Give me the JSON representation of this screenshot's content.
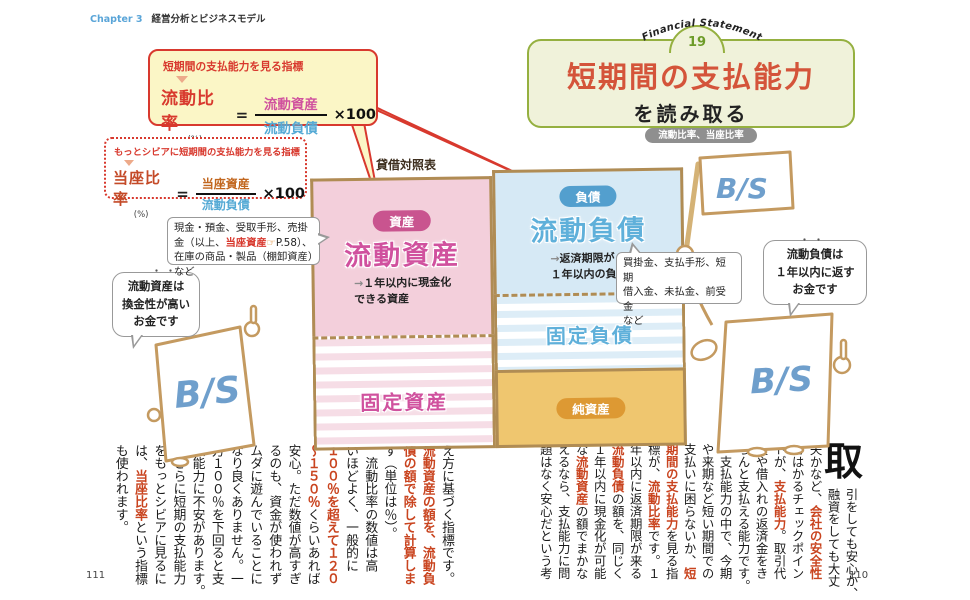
{
  "palette": {
    "accent_red": "#d8392e",
    "title_red": "#d4543a",
    "frame_green": "#95b040",
    "asset_pink": "#d0519e",
    "liability_blue": "#55aad5",
    "sheet_tan": "#b08c54",
    "net_orange": "#dd9933",
    "body_red": "#c9441f",
    "bs_blue": "#6f9fcc"
  },
  "header": {
    "chapter": "Chapter 3",
    "title": "経営分析とビジネスモデル"
  },
  "badge": {
    "arc_text": "Financial Statement",
    "number": "19"
  },
  "title_block": {
    "main": "短期間の支払能力",
    "sub": "を読み取る",
    "pill": "流動比率、当座比率"
  },
  "formulas": {
    "current_ratio": {
      "caption": "短期間の支払能力を見る指標",
      "name": "流動比率",
      "unit": "(%)",
      "equals": "=",
      "numerator": "流動資産",
      "denominator": "流動負債",
      "times": "×100"
    },
    "quick_ratio": {
      "caption": "もっとシビアに短期間の支払能力を見る指標",
      "name": "当座比率",
      "unit": "(%)",
      "equals": "=",
      "numerator": "当座資産",
      "denominator": "流動負債",
      "times": "×100"
    }
  },
  "balance_sheet": {
    "title": "貸借対照表",
    "assets_badge": "資産",
    "current_assets": "流動資産",
    "current_assets_desc": "→１年以内に現金化\nできる資産",
    "fixed_assets": "固定資産",
    "liabilities_badge": "負債",
    "current_liabilities": "流動負債",
    "current_liabilities_desc": "→返済期限が\n１年以内の負債",
    "fixed_liabilities": "固定負債",
    "net_assets": "純資産"
  },
  "notes": {
    "assets_note": {
      "segments": [
        {
          "t": "現金・預金、受取手形、売掛金（以上、"
        },
        {
          "t": "当座資産",
          "cls": "red"
        },
        {
          "t": "☞",
          "cls": "orange"
        },
        {
          "t": "P.58）、在庫の商品・製品（棚卸資産）など"
        }
      ]
    },
    "liabilities_note": "買掛金、支払手形、短期\n借入金、未払金、前受金\nなど"
  },
  "characters": {
    "bs_label": "B/S",
    "left_bubble": "流動資産は\n換金性が高い\nお金です",
    "left_bubble_dots": "・・",
    "right_bubble": "流動負債は\n１年以内に返す\nお金です",
    "right_bubble_dots": "・・"
  },
  "body_right_page": {
    "drop_cap": "取",
    "columns": [
      {
        "indent": true,
        "s": [
          {
            "t": "引をしても安心か、"
          }
        ]
      },
      {
        "indent": true,
        "s": [
          {
            "t": "融資をしても大丈"
          }
        ]
      },
      {
        "s": [
          {
            "t": "夫かなど、"
          },
          {
            "t": "会社の安全性",
            "cls": "red"
          }
        ]
      },
      {
        "s": [
          {
            "t": "をはかるチェックポイン"
          }
        ]
      },
      {
        "s": [
          {
            "t": "トが、"
          },
          {
            "t": "支払能力",
            "cls": "red"
          },
          {
            "t": "。取引代"
          }
        ]
      },
      {
        "s": [
          {
            "t": "金や借入れの返済金をき"
          }
        ]
      },
      {
        "s": [
          {
            "t": "ちんと支払える能力です。"
          }
        ]
      },
      {
        "s": [
          {
            "t": "　支払能力の中で、今期"
          }
        ]
      },
      {
        "s": [
          {
            "t": "や来期など短い期間での"
          }
        ]
      },
      {
        "s": [
          {
            "t": "支払いに困らないか、"
          },
          {
            "t": "短",
            "cls": "red"
          }
        ]
      },
      {
        "s": [
          {
            "t": "期間の支払能力",
            "cls": "red"
          },
          {
            "t": "を見る指"
          }
        ]
      },
      {
        "s": [
          {
            "t": "標が、"
          },
          {
            "t": "流動比率",
            "cls": "red"
          },
          {
            "t": "です。１"
          }
        ]
      },
      {
        "s": [
          {
            "t": "年以内に返済期限が来る"
          }
        ]
      },
      {
        "s": [
          {
            "t": "流動負債",
            "cls": "red"
          },
          {
            "t": "の額を、同じく"
          }
        ]
      },
      {
        "s": [
          {
            "t": "１年以内に現金化が可能"
          }
        ]
      },
      {
        "s": [
          {
            "t": "な"
          },
          {
            "t": "流動資産",
            "cls": "red"
          },
          {
            "t": "の額でまかな"
          }
        ]
      },
      {
        "s": [
          {
            "t": "えるなら、支払能力に問"
          }
        ]
      },
      {
        "s": [
          {
            "t": "題はなく安心だという考"
          }
        ]
      }
    ]
  },
  "body_left_page": {
    "columns": [
      {
        "s": [
          {
            "t": "え方に基づく指標です。"
          }
        ]
      },
      {
        "s": [
          {
            "t": "流動資産の額を、流動負",
            "cls": "red"
          }
        ]
      },
      {
        "s": [
          {
            "t": "債の額で除して計算しま",
            "cls": "red"
          }
        ]
      },
      {
        "s": [
          {
            "t": "す（単位は％）。"
          }
        ]
      },
      {
        "s": [
          {
            "t": "　流動比率の数値は高"
          }
        ]
      },
      {
        "s": [
          {
            "t": "いほどよく、一般的に"
          }
        ]
      },
      {
        "s": [
          {
            "t": "１００％を超えて１２０",
            "cls": "red"
          }
        ]
      },
      {
        "s": [
          {
            "t": "～１５０％",
            "cls": "red"
          },
          {
            "t": "くらいあれば"
          }
        ]
      },
      {
        "s": [
          {
            "t": "安心。ただ数値が高すぎ"
          }
        ]
      },
      {
        "s": [
          {
            "t": "るのも、資金が使われず"
          }
        ]
      },
      {
        "s": [
          {
            "t": "ムダに遊んでいることに"
          }
        ]
      },
      {
        "s": [
          {
            "t": "なり良くありません。一"
          }
        ]
      },
      {
        "s": [
          {
            "t": "方１００％を下回ると支"
          }
        ]
      },
      {
        "s": [
          {
            "t": "払能力に不安があります。"
          }
        ]
      },
      {
        "s": [
          {
            "t": "　さらに短期の支払能力"
          }
        ]
      },
      {
        "s": [
          {
            "t": "をもっとシビアに見るに"
          }
        ]
      },
      {
        "s": [
          {
            "t": "は、"
          },
          {
            "t": "当座比率",
            "cls": "red"
          },
          {
            "t": "という指標"
          }
        ]
      },
      {
        "s": [
          {
            "t": "も使われます。"
          }
        ]
      }
    ]
  },
  "page_numbers": {
    "left": "111",
    "right": "110"
  }
}
